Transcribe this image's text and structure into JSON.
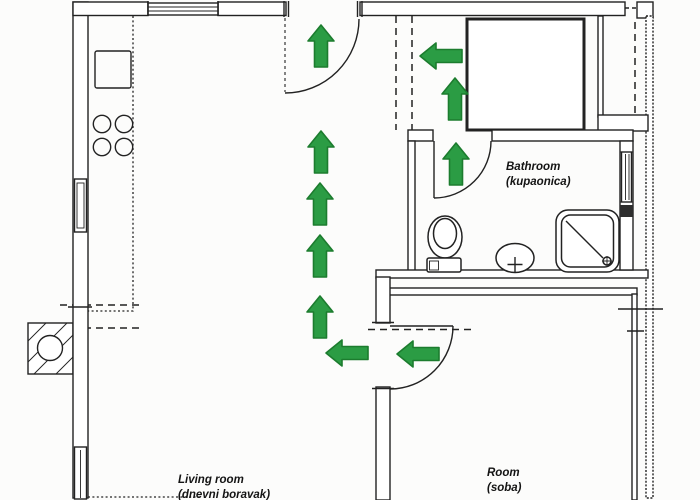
{
  "colors": {
    "line": "#222222",
    "background": "#fcfcfb",
    "arrow": "#2b9c44",
    "arrow_outline": "#1c7c2e"
  },
  "rooms": {
    "living_room": {
      "label": "Living room",
      "sublabel": "(dnevni boravak)"
    },
    "bathroom": {
      "label": "Bathroom",
      "sublabel": "(kupaonica)"
    },
    "room": {
      "label": "Room",
      "sublabel": "(soba)"
    }
  },
  "fixtures": [
    "kitchen-counter",
    "kitchen-sink",
    "stove-burners",
    "chimney-flue",
    "entrance-door",
    "bathroom-door",
    "room-door",
    "toilet",
    "washbasin",
    "shower-cabin",
    "closet",
    "window-top",
    "window-left-upper",
    "window-left-lower",
    "window-bathroom"
  ],
  "arrows": [
    {
      "direction": "up",
      "x": 321,
      "y": 46
    },
    {
      "direction": "up",
      "x": 321,
      "y": 152
    },
    {
      "direction": "up",
      "x": 320,
      "y": 204
    },
    {
      "direction": "up",
      "x": 320,
      "y": 256
    },
    {
      "direction": "up",
      "x": 320,
      "y": 317
    },
    {
      "direction": "left",
      "x": 347,
      "y": 353
    },
    {
      "direction": "left",
      "x": 418,
      "y": 354
    },
    {
      "direction": "left",
      "x": 441,
      "y": 56
    },
    {
      "direction": "up",
      "x": 455,
      "y": 99
    },
    {
      "direction": "up",
      "x": 456,
      "y": 164
    }
  ]
}
